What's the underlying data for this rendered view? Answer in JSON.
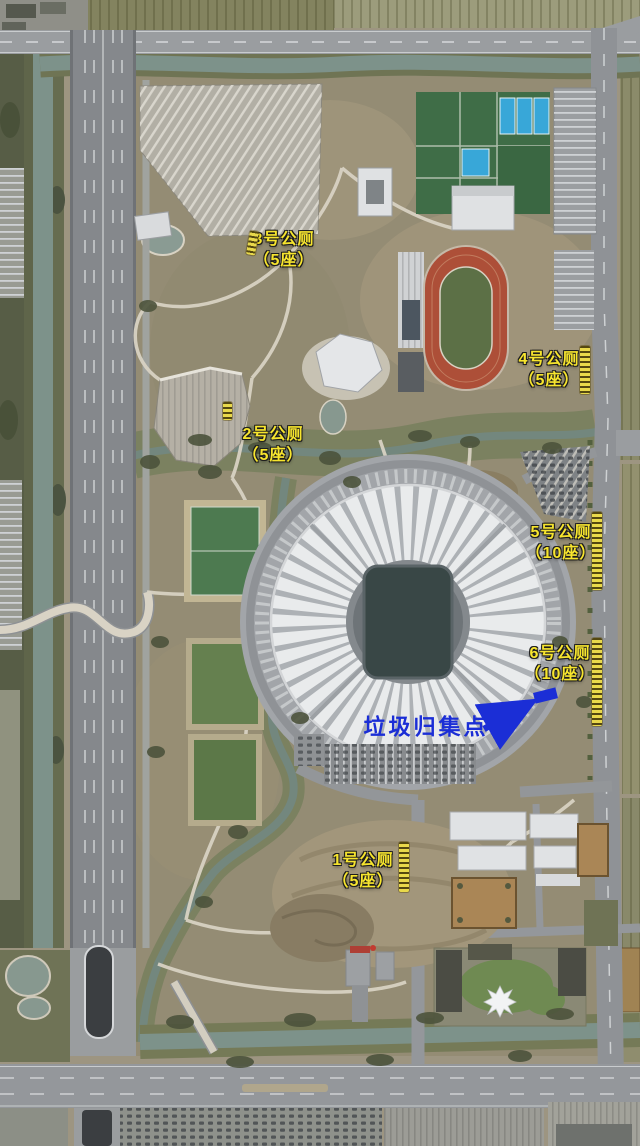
{
  "map_overlay": {
    "toilet_labels": [
      {
        "name": "toilet-3",
        "line1": "3号公厕",
        "line2": "（5座）",
        "x": 284,
        "y": 250
      },
      {
        "name": "toilet-2",
        "line1": "2号公厕",
        "line2": "（5座）",
        "x": 273,
        "y": 445
      },
      {
        "name": "toilet-4",
        "line1": "4号公厕",
        "line2": "（5座）",
        "x": 549,
        "y": 370
      },
      {
        "name": "toilet-5",
        "line1": "5号公厕",
        "line2": "（10座）",
        "x": 561,
        "y": 543
      },
      {
        "name": "toilet-6",
        "line1": "6号公厕",
        "line2": "（10座）",
        "x": 560,
        "y": 664
      },
      {
        "name": "toilet-1",
        "line1": "1号公厕",
        "line2": "（5座）",
        "x": 363,
        "y": 871
      }
    ],
    "label_style": {
      "color": "#f7e52e",
      "outline": "#1c1c1c"
    },
    "garbage_point": {
      "label": "垃圾归集点",
      "color": "#1b2ed6",
      "x": 426,
      "y": 727,
      "arrow": {
        "x1": 484,
        "y1": 729,
        "x2": 527,
        "y2": 705
      },
      "marker": {
        "x": 533,
        "y": 693,
        "w": 23,
        "h": 11,
        "rotate": -14
      }
    },
    "watermark_strips": {
      "color": "#e9d94b",
      "items": [
        {
          "x": 248,
          "y": 231,
          "w": 9,
          "h": 24,
          "rotate": 10
        },
        {
          "x": 223,
          "y": 402,
          "w": 9,
          "h": 18,
          "rotate": 0
        },
        {
          "x": 580,
          "y": 346,
          "w": 10,
          "h": 48,
          "rotate": 0
        },
        {
          "x": 592,
          "y": 512,
          "w": 10,
          "h": 78,
          "rotate": 0
        },
        {
          "x": 592,
          "y": 638,
          "w": 10,
          "h": 88,
          "rotate": 0
        },
        {
          "x": 399,
          "y": 842,
          "w": 10,
          "h": 50,
          "rotate": 0
        }
      ]
    }
  }
}
